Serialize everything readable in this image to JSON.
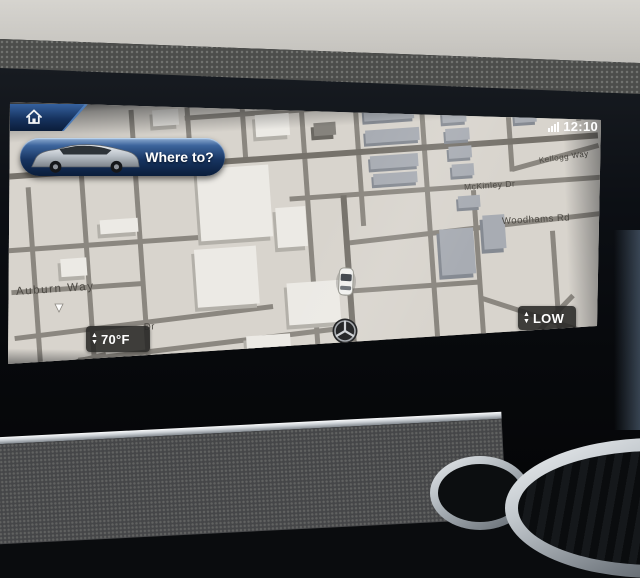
{
  "status_bar": {
    "time": "12:10",
    "signal_icon": "cellular-signal"
  },
  "nav_ui": {
    "home_button": {
      "icon": "home"
    },
    "where_to": {
      "label": "Where to?",
      "vehicle_image": "silver-suv-side-view"
    },
    "temperature_control": {
      "value": "70°F",
      "up": "▲",
      "down": "▼"
    },
    "map_level_control": {
      "label": "LOW",
      "up": "▲",
      "down": "▼"
    }
  },
  "map": {
    "street_labels": {
      "auburn": "Auburn Way",
      "mckinley": "McKinley Dr",
      "woodhams": "Woodhams Rd",
      "kellogg": "Kellogg Way",
      "partial_dr": "Dr"
    },
    "markers": {
      "vehicle": "car-top-view",
      "brand": "mercedes-star"
    }
  },
  "colors": {
    "accent_blue": "#16335f",
    "accent_blue_highlight": "#8fadd2",
    "map_background": "#d8d4cd",
    "road": "#8b8780",
    "control_badge": "#282826",
    "text_on_map": "#4c4943"
  }
}
